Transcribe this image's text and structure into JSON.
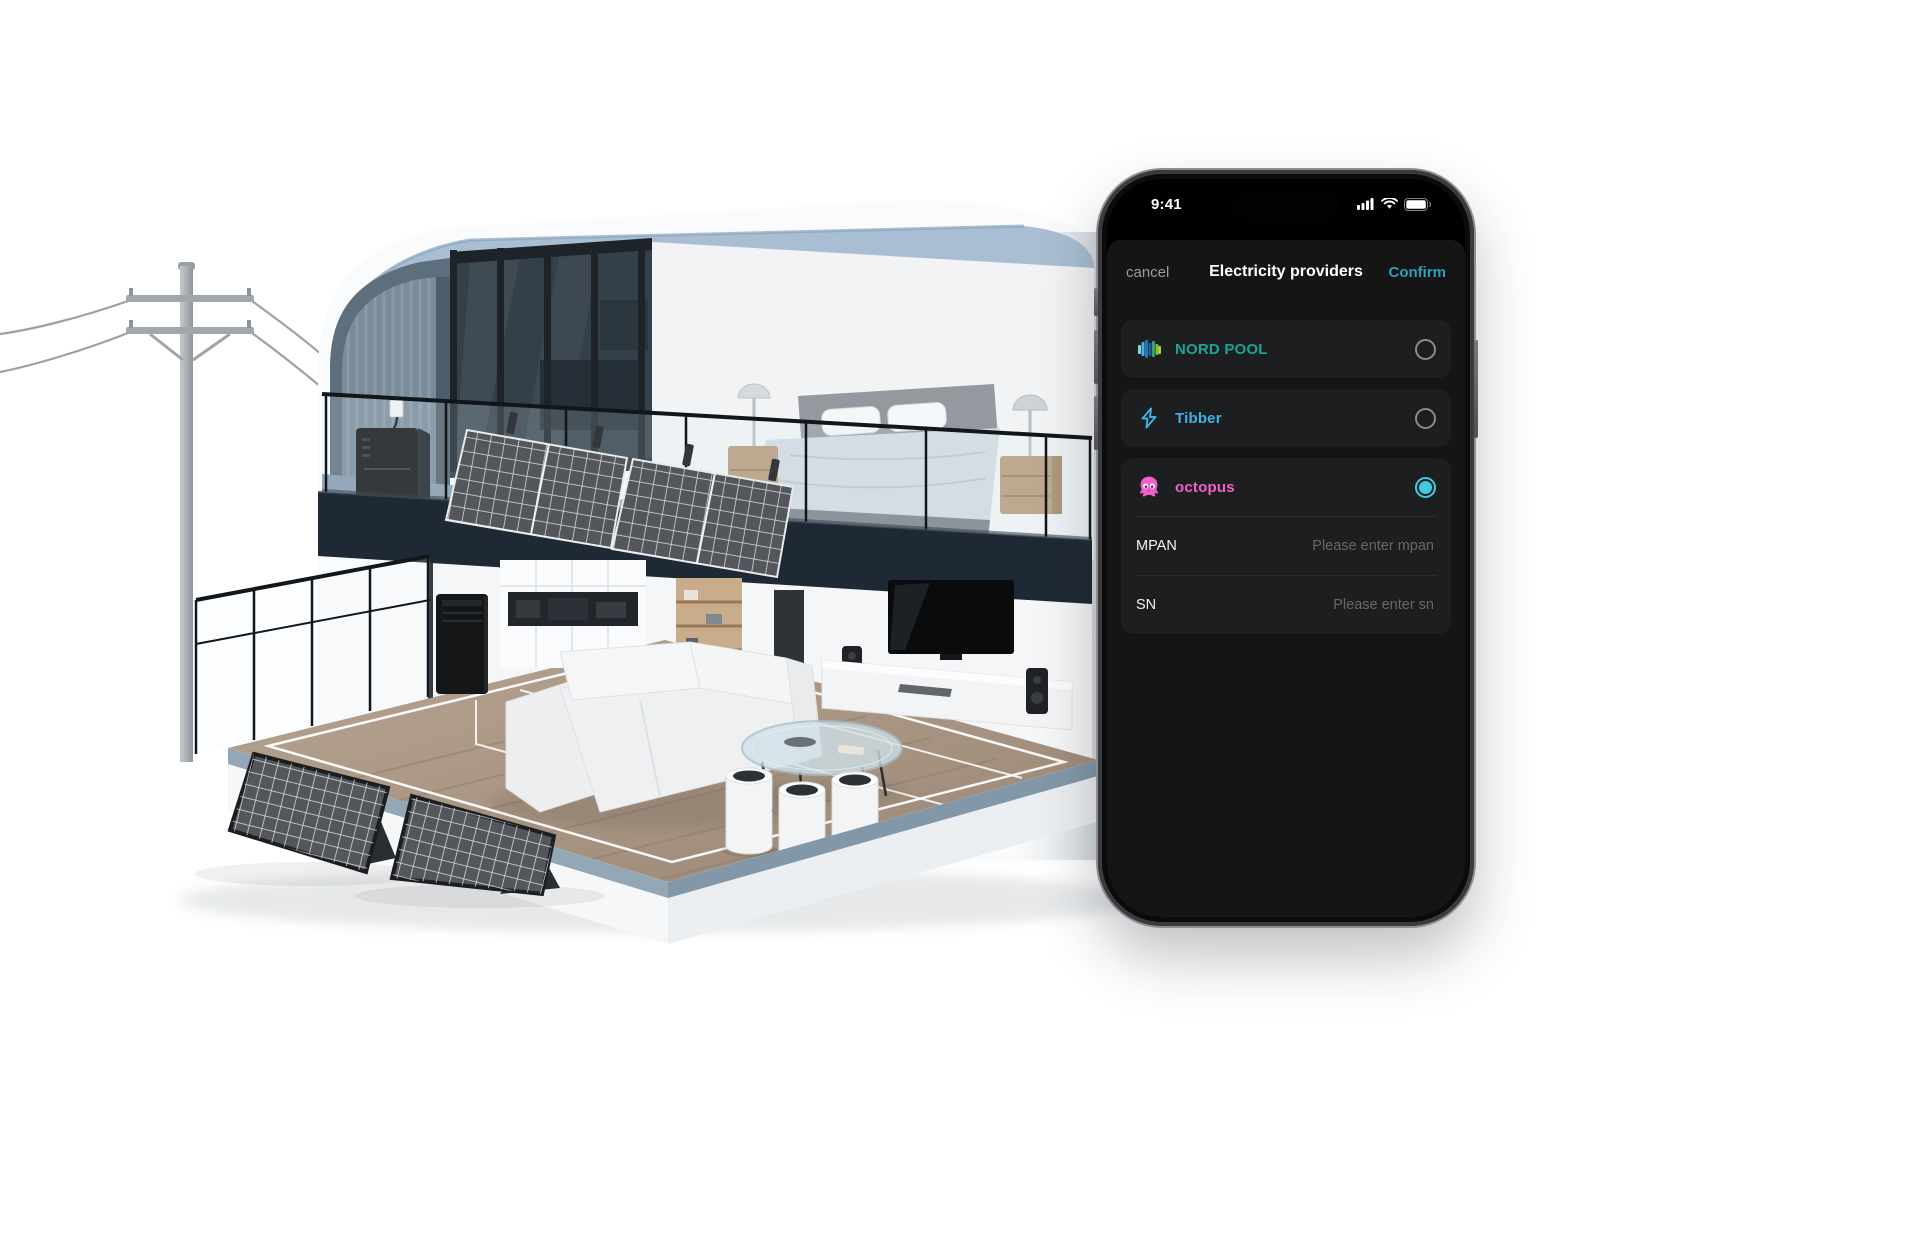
{
  "status_bar": {
    "time": "9:41",
    "icons": [
      "cellular-signal-icon",
      "wifi-icon",
      "battery-icon"
    ]
  },
  "modal": {
    "cancel_label": "cancel",
    "title": "Electricity providers",
    "confirm_label": "Confirm",
    "confirm_color": "#2f9fb3"
  },
  "providers": [
    {
      "name": "NORD POOL",
      "selected": false,
      "color": "#1ca595",
      "icon": "nord-pool-logo"
    },
    {
      "name": "Tibber",
      "selected": false,
      "color": "#3cb3e6",
      "icon": "tibber-bolt"
    },
    {
      "name": "octopus",
      "selected": true,
      "color": "#f25fce",
      "icon": "octopus"
    }
  ],
  "fields": [
    {
      "label": "MPAN",
      "value": "",
      "placeholder": "Please enter mpan"
    },
    {
      "label": "SN",
      "value": "",
      "placeholder": "Please enter sn"
    }
  ],
  "ui_colors": {
    "radio_selected": "#41cbe0",
    "card_background": "#1d1e1f",
    "sheet_background": "#151516"
  },
  "scene_palette": {
    "roof": "#a9bed2",
    "dark_wall": "#5d6e7c",
    "slab": "#1f2935",
    "wood_floor": "#ab9480",
    "solar_panel": "#53575b"
  }
}
